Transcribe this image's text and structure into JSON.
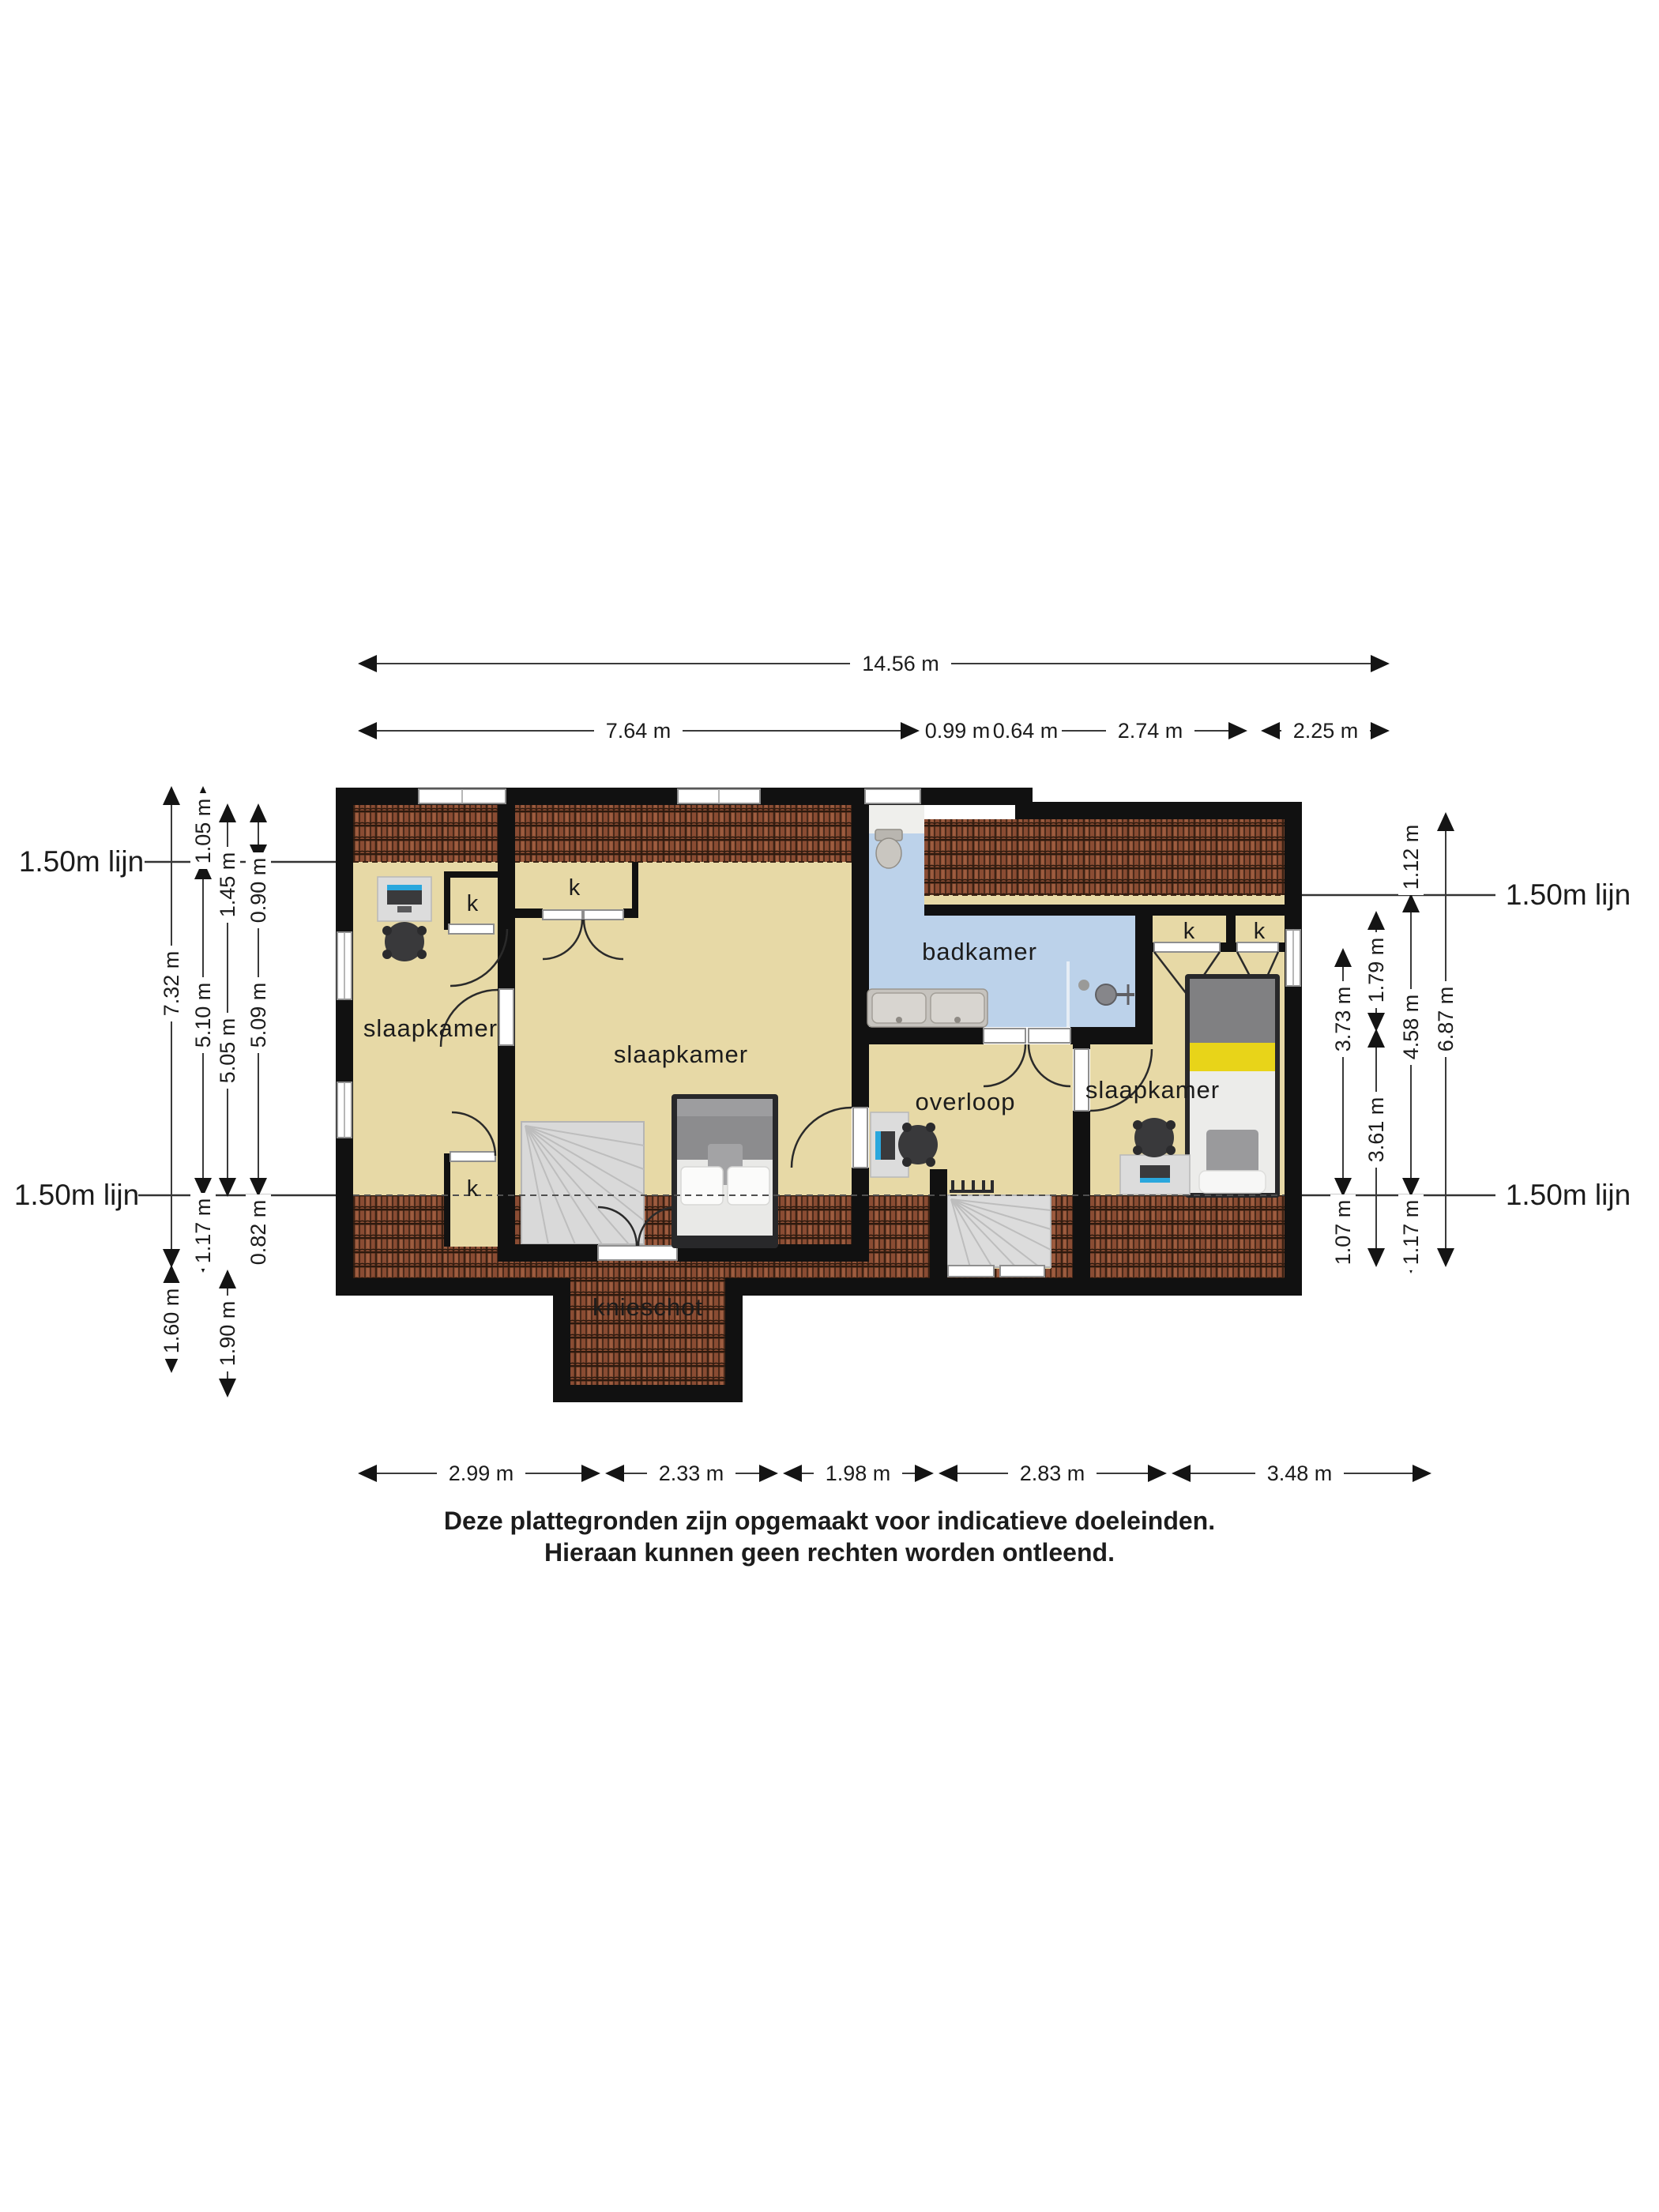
{
  "title_labels": {
    "line_marker": "1.50m lijn"
  },
  "rooms": {
    "bedroom_left": "slaapkamer",
    "bedroom_middle": "slaapkamer",
    "bedroom_right": "slaapkamer",
    "bathroom": "badkamer",
    "landing": "overloop",
    "knee_wall": "knieschot",
    "closet_left_top": "k",
    "closet_left_bottom": "k",
    "closet_middle": "k",
    "closet_right_1": "k",
    "closet_right_2": "k"
  },
  "dimensions_top": {
    "total": "14.56 m",
    "segments": [
      "7.64 m",
      "0.99 m",
      "0.64 m",
      "2.74 m",
      "2.25 m"
    ]
  },
  "dimensions_bottom": {
    "segments": [
      "2.99 m",
      "2.33 m",
      "1.98 m",
      "2.83 m",
      "3.48 m"
    ]
  },
  "dimensions_left": {
    "col1": [
      "7.32 m",
      "1.60 m"
    ],
    "col2": [
      "1.05 m",
      "5.10 m",
      "1.17 m"
    ],
    "col3": [
      "1.45 m",
      "5.05 m",
      "1.90 m"
    ],
    "col4": [
      "0.90 m",
      "5.09 m",
      "0.82 m"
    ]
  },
  "dimensions_right": {
    "col1": [
      "3.73 m",
      "1.07 m"
    ],
    "col2": [
      "1.79 m",
      "3.61 m"
    ],
    "col3": [
      "1.12 m",
      "4.58 m",
      "1.17 m"
    ],
    "col4": [
      "6.87 m"
    ]
  },
  "disclaimer": {
    "line1": "Deze plattegronden zijn opgemaakt voor indicatieve doeleinden.",
    "line2": "Hieraan kunnen geen rechten worden ontleend."
  },
  "colors": {
    "wall": "#111111",
    "floor": "#e7d9a6",
    "bathroom_floor": "#bcd2ea",
    "roof_tile": "#8a4c33",
    "stairs": "#d9d9d9",
    "bed_dark": "#28282a",
    "accent_yellow": "#e8d419",
    "screen_blue": "#2aa7dd"
  }
}
